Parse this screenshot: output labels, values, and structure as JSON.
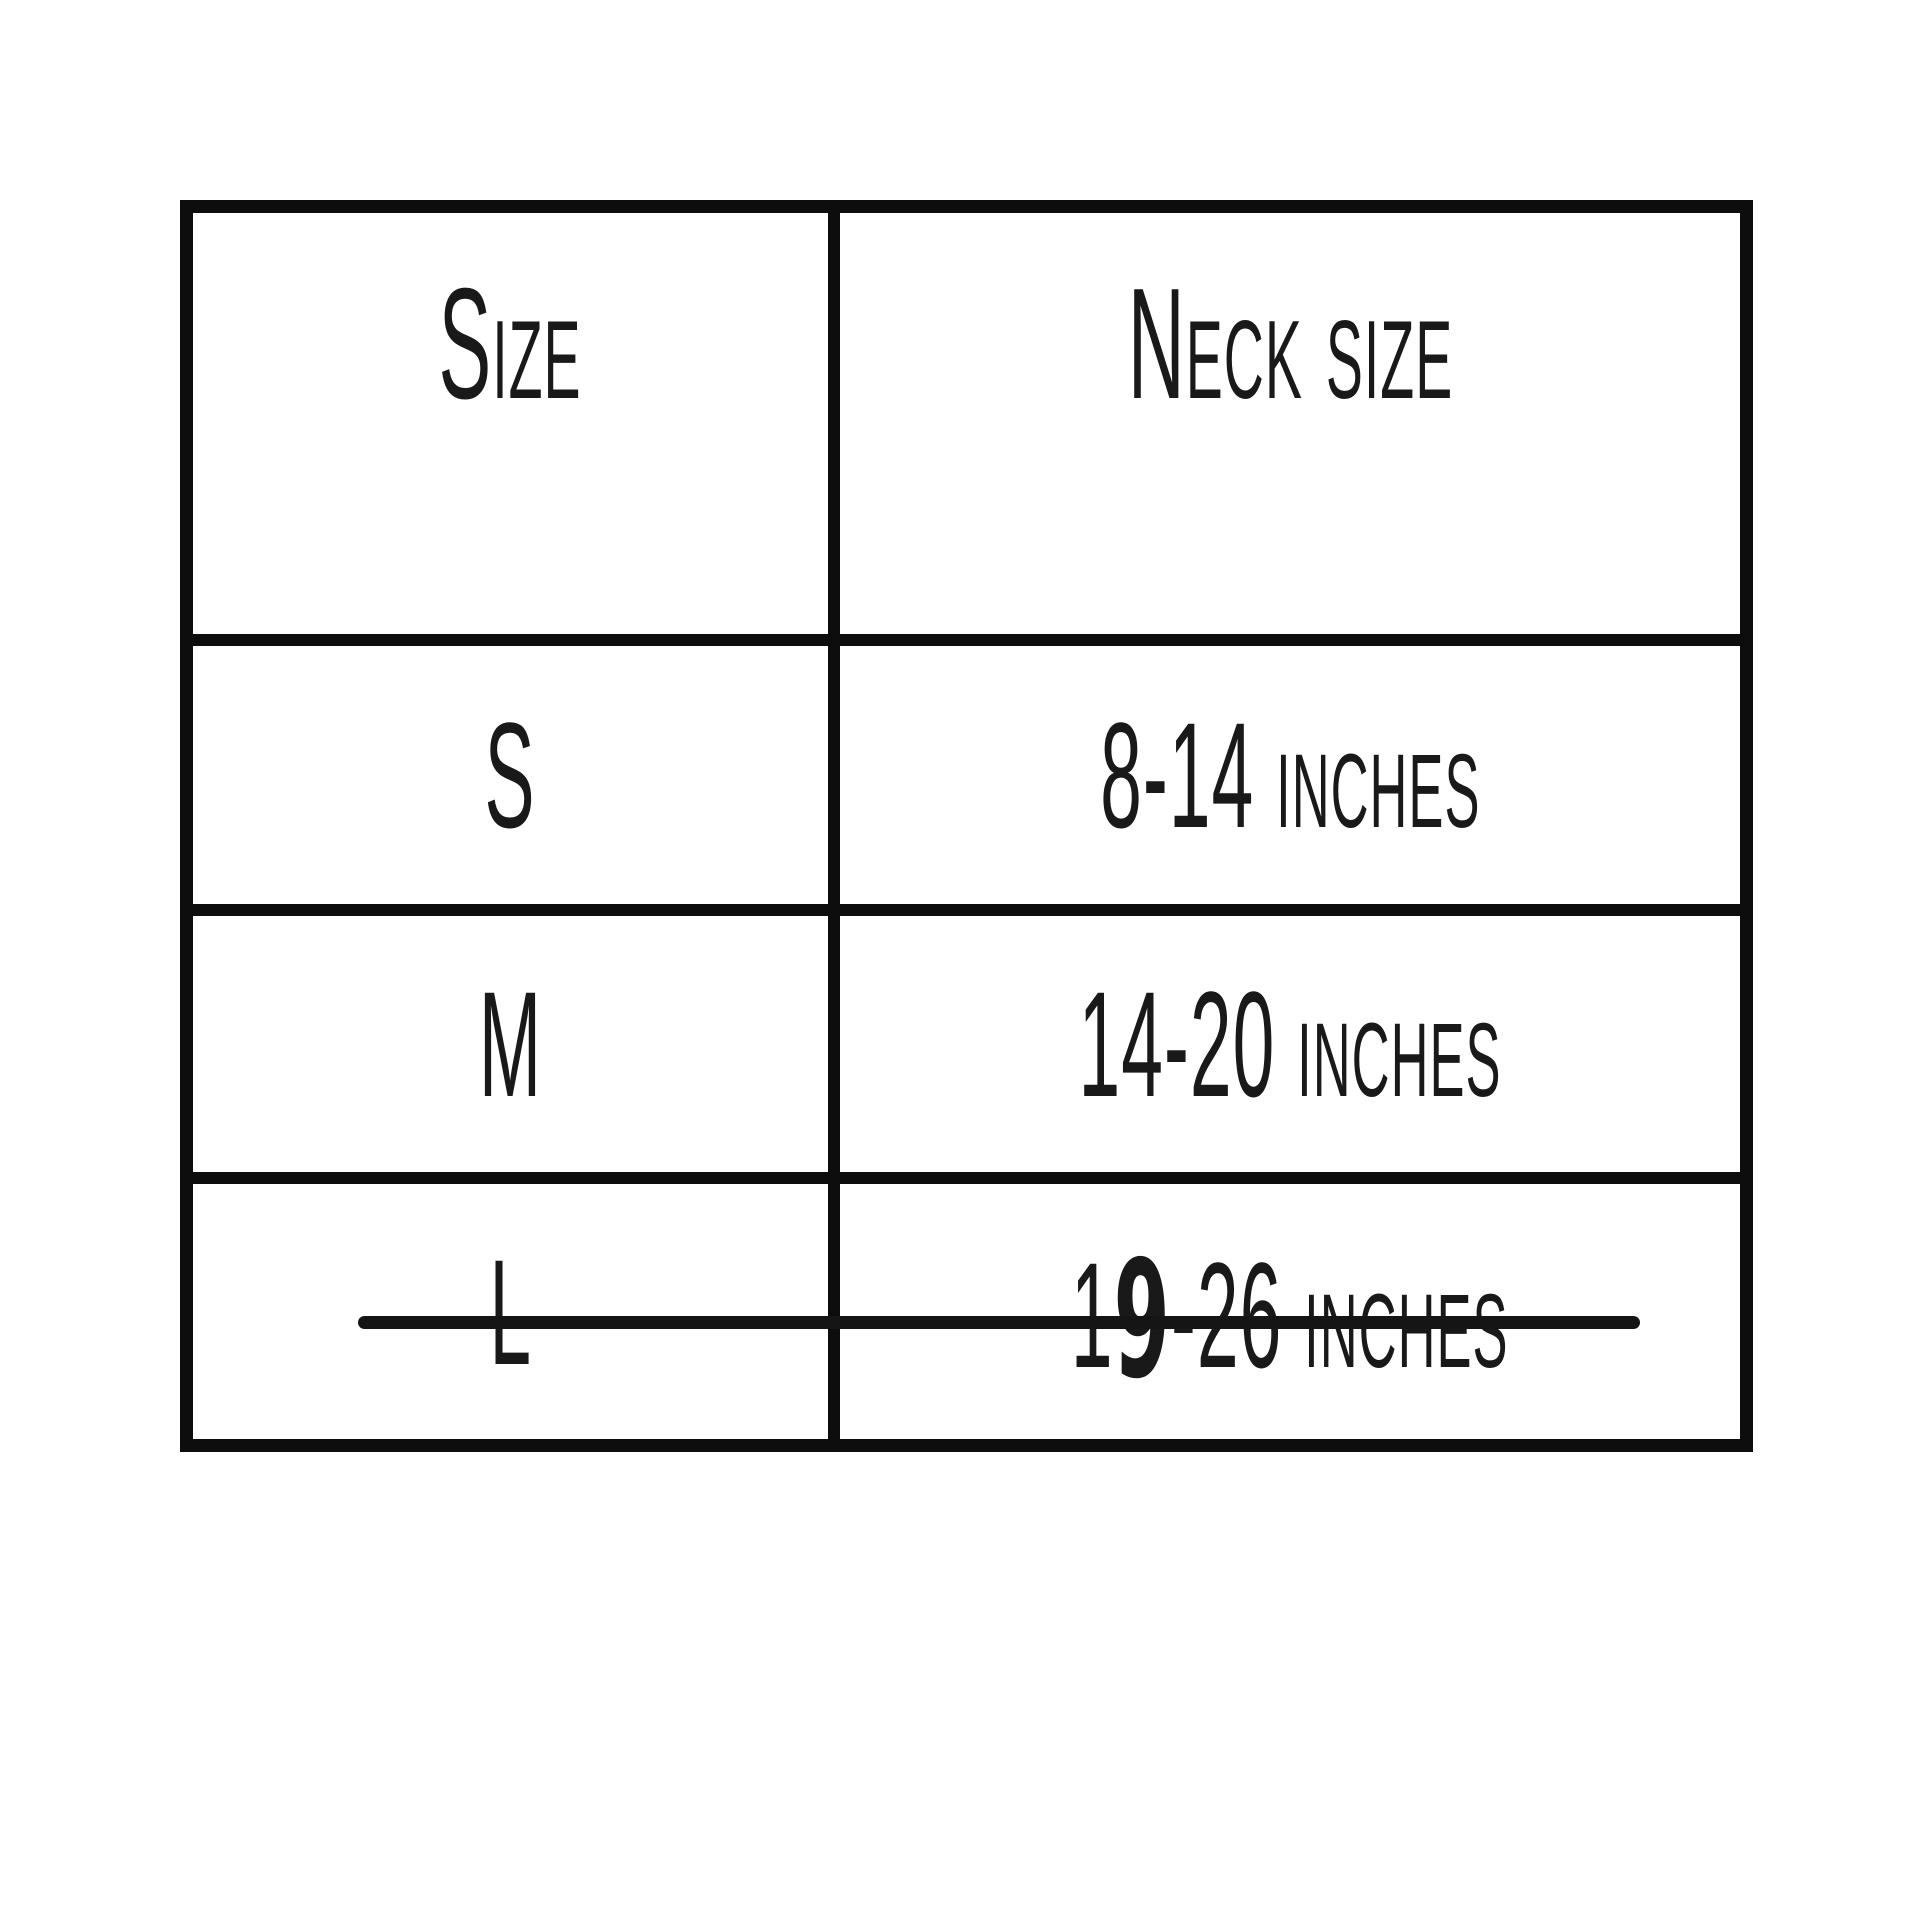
{
  "chart_data": {
    "type": "table",
    "columns": [
      "Size",
      "Neck size"
    ],
    "rows": [
      [
        "S",
        "8-14 inches"
      ],
      [
        "M",
        "14-20 inches"
      ],
      [
        "L",
        "19-26 inches"
      ]
    ],
    "title": "",
    "annotations": [
      "Entire L row is crossed out with a single horizontal hand-drawn strikethrough line",
      "The digit 9 in '19-26 inches' is handwritten in thicker pen over the printed text"
    ],
    "grid": "on",
    "legend": "none"
  },
  "table": {
    "header": {
      "size_label": "Size",
      "neck_size_label": "Neck size"
    },
    "rows": [
      {
        "size": "S",
        "neck_size": "8-14 inches",
        "struck_out": false
      },
      {
        "size": "M",
        "neck_size": "14-20 inches",
        "struck_out": false
      },
      {
        "size": "L",
        "neck_size": "19-26 inches",
        "neck_size_parts": {
          "printed_prefix": "1",
          "handwritten_digit": "9",
          "printed_suffix": "-26 inches"
        },
        "struck_out": true
      }
    ]
  },
  "colors": {
    "background": "#ffffff",
    "rule_lines": "#0d0d0d",
    "text": "#191919",
    "strikethrough": "#151515"
  }
}
